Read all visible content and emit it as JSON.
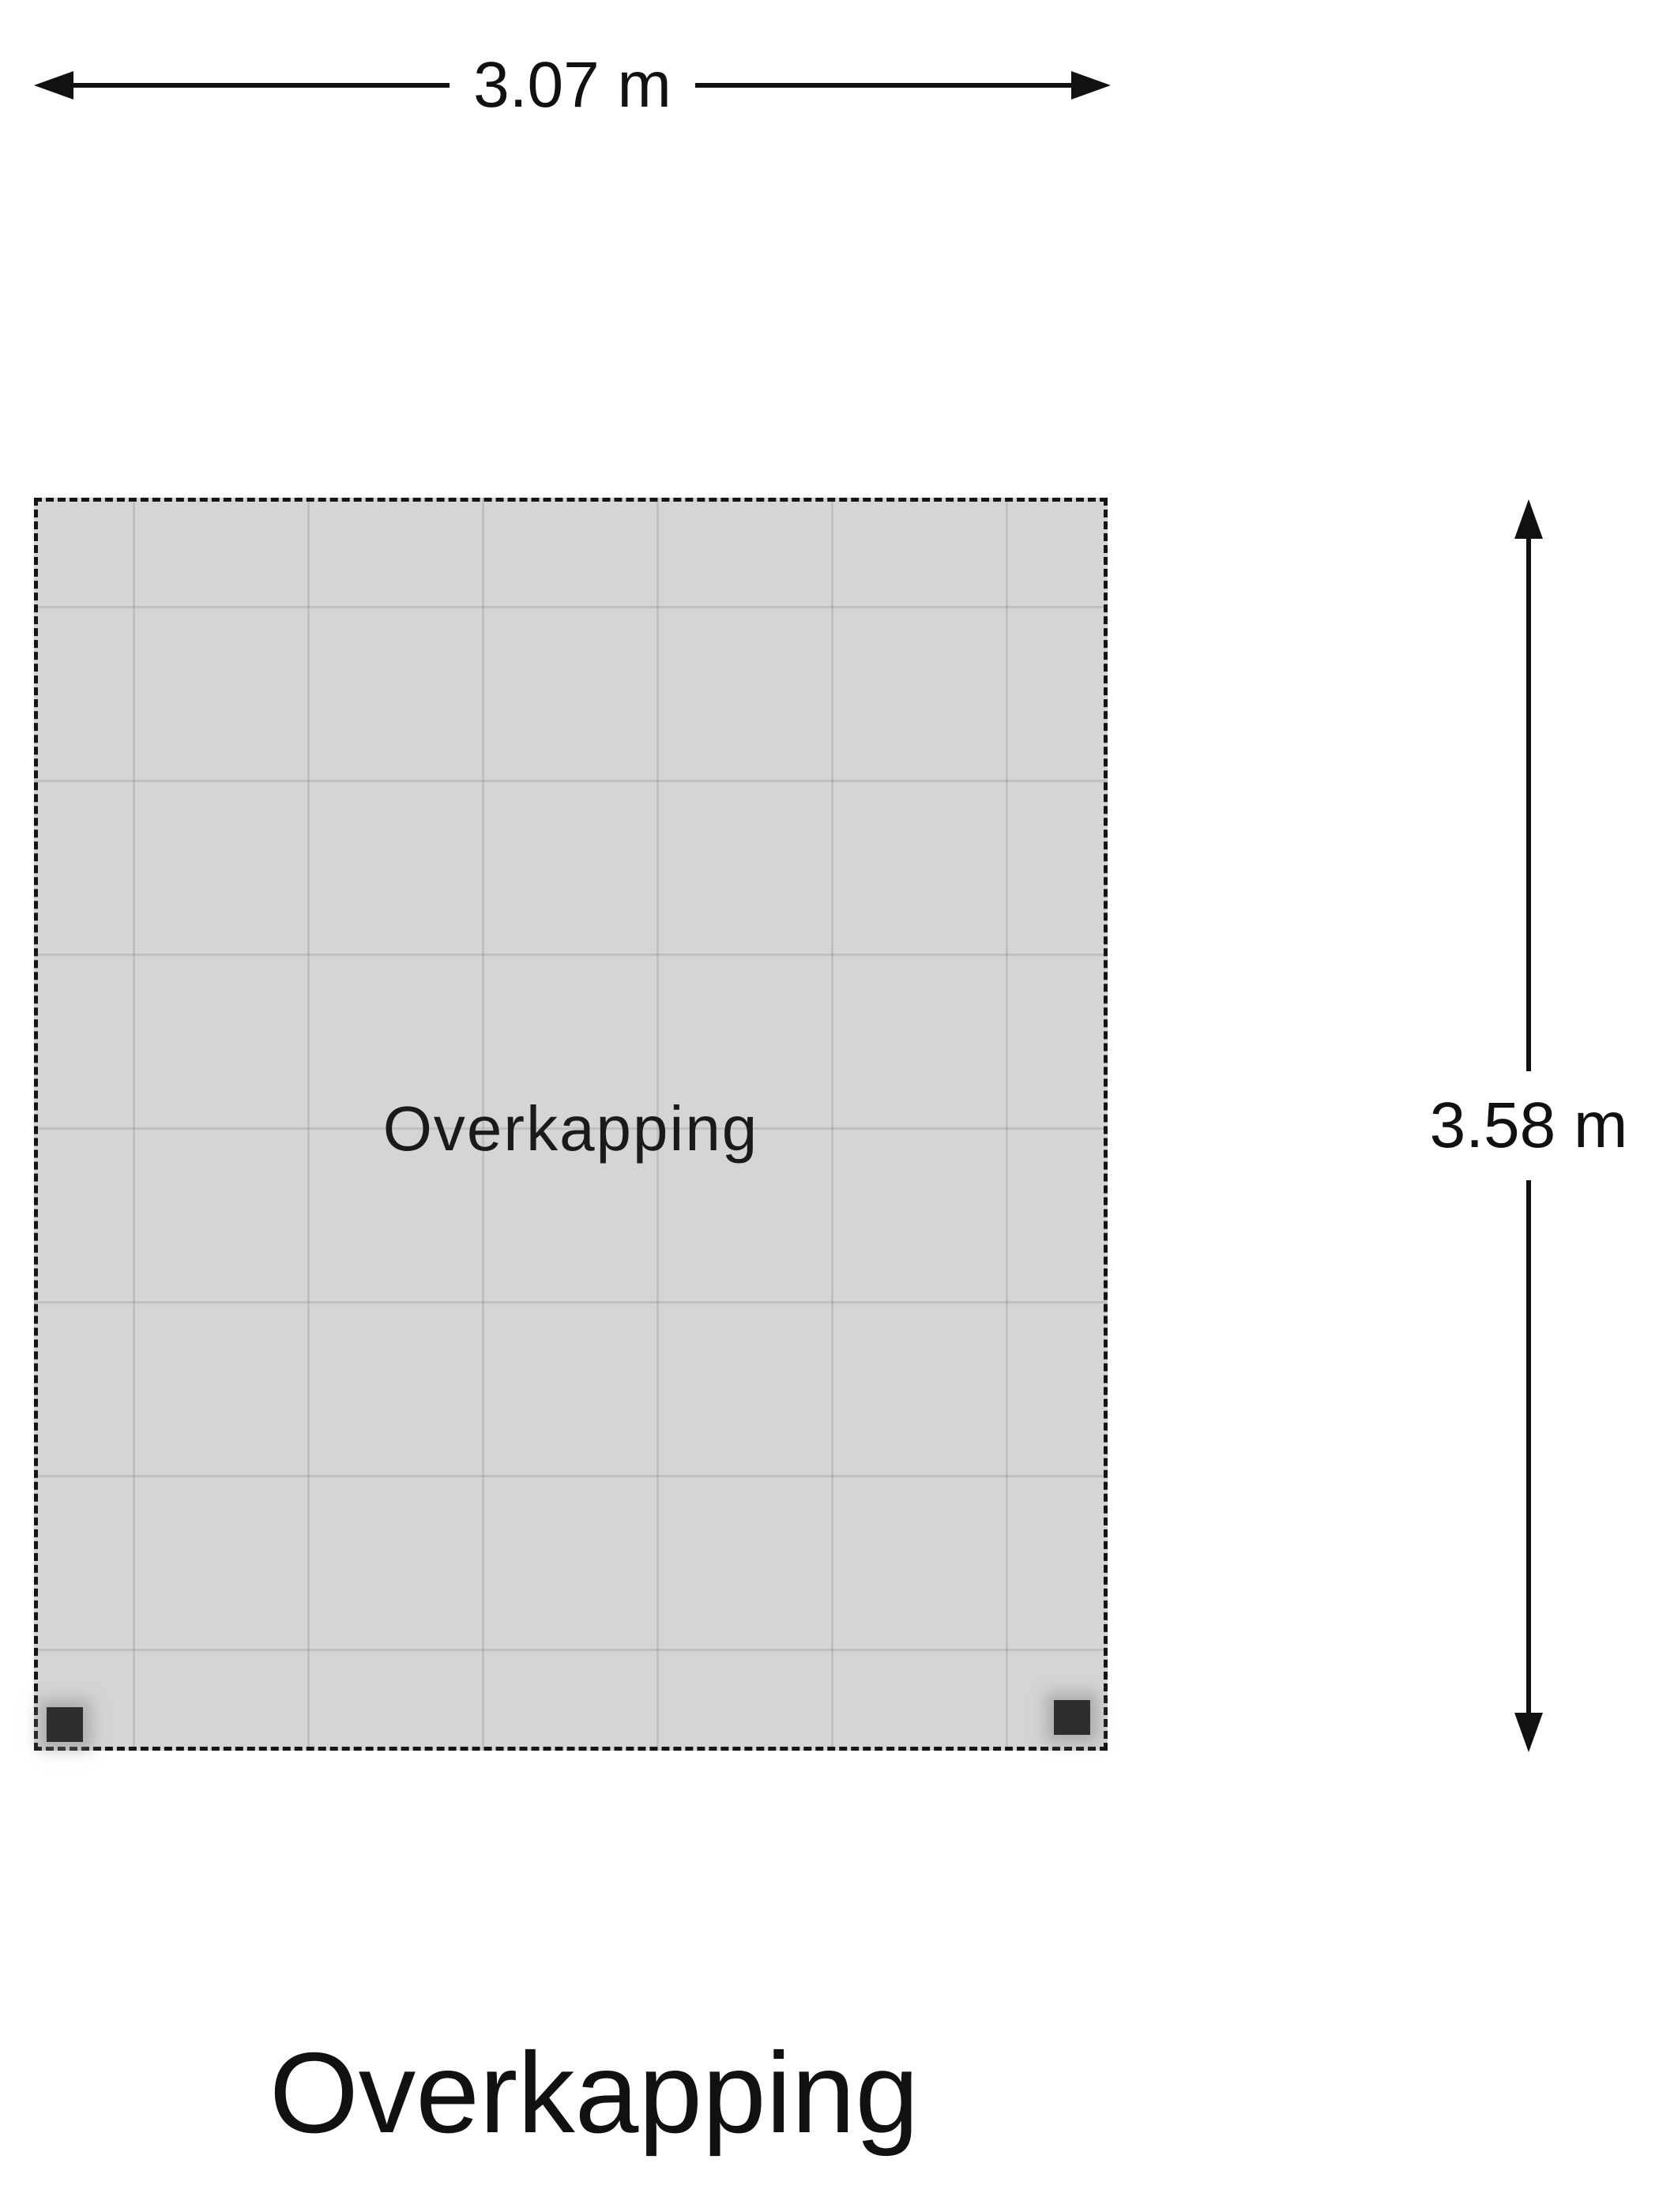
{
  "plan": {
    "title": "Overkapping",
    "room": {
      "label": "Overkapping",
      "width_label": "3.07 m",
      "height_label": "3.58 m",
      "post_count": 2
    },
    "colors": {
      "background": "#ffffff",
      "floor_fill": "#d5d5d5",
      "floor_grid": "#c9c9c9",
      "floor_border": "#151515",
      "dimension_line": "#111111",
      "text": "#111111",
      "post": "#2e2e2e"
    }
  }
}
